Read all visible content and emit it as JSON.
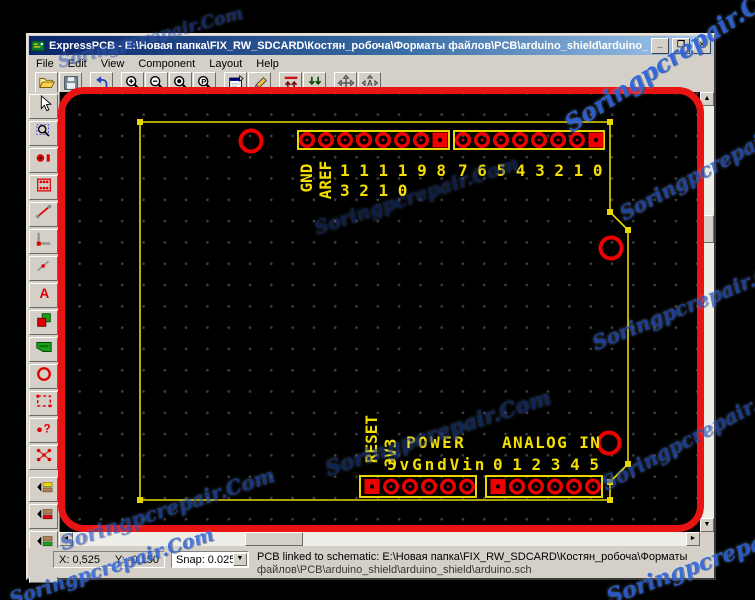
{
  "window": {
    "title": "ExpressPCB - E:\\Новая папка\\FIX_RW_SDCARD\\Костян_робоча\\Форматы файлов\\PCB\\arduino_shield\\arduino_shield\\arduino.pcb",
    "minimize": "_",
    "maximize": "❐",
    "close": "×"
  },
  "menu": {
    "items": [
      "File",
      "Edit",
      "View",
      "Component",
      "Layout",
      "Help"
    ]
  },
  "toolbar": {
    "buttons": [
      "open",
      "save",
      "undo",
      "zoom-in",
      "zoom-out",
      "zoom-to-board",
      "zoom-previous",
      "component-properties",
      "component-edit",
      "view-top-layer",
      "view-bottom-layer",
      "pan",
      "pan-auto"
    ]
  },
  "tool_palette": {
    "buttons": [
      "select",
      "zoom-window",
      "pad",
      "component",
      "trace",
      "corner-in-trace",
      "segment",
      "text",
      "rectangle",
      "power-plane",
      "circle",
      "board-outline",
      "find-pad",
      "ratsnest",
      "layer-silkscreen",
      "layer-top-copper",
      "layer-bottom-copper",
      "via"
    ]
  },
  "pcb": {
    "top_left_header": {
      "label_gnd": "GND",
      "label_aref": "AREF",
      "digits_row1": "1 1 1 1 9 8",
      "digits_row2": "3 2 1 0"
    },
    "top_right_header": {
      "digits": "7 6 5 4 3 2 1 0"
    },
    "bottom_left_header": {
      "label_reset": "RESET",
      "label_3v3": "3V3",
      "title": "POWER",
      "pins": "5vGndVin"
    },
    "bottom_right_header": {
      "title": "ANALOG IN",
      "pins": "0 1 2 3 4 5"
    },
    "mounting_holes": 3,
    "connectors": [
      {
        "id": "top-left",
        "pads": 8,
        "square_pad": "last"
      },
      {
        "id": "top-right",
        "pads": 8,
        "square_pad": "last"
      },
      {
        "id": "bottom-left",
        "pads": 6,
        "square_pad": "first"
      },
      {
        "id": "bottom-right",
        "pads": 6,
        "square_pad": "first"
      }
    ]
  },
  "status_bar": {
    "x_coord": "X: 0,525",
    "y_coord": "Y: -0,150",
    "snap": "Snap: 0.025\"",
    "message_line1": "PCB linked to schematic:  E:\\Новая папка\\FIX_RW_SDCARD\\Костян_робоча\\Форматы",
    "message_line2": "файлов\\PCB\\arduino_shield\\arduino_shield\\arduino.sch"
  },
  "watermark": {
    "text": "Soringpcrepair.Com"
  },
  "colors": {
    "board_yellow": "#e8d800",
    "pad_red": "#ee0000",
    "annotation_red": "#e81414",
    "titlebar_blue": "#0a246a",
    "canvas_black": "#000000"
  }
}
